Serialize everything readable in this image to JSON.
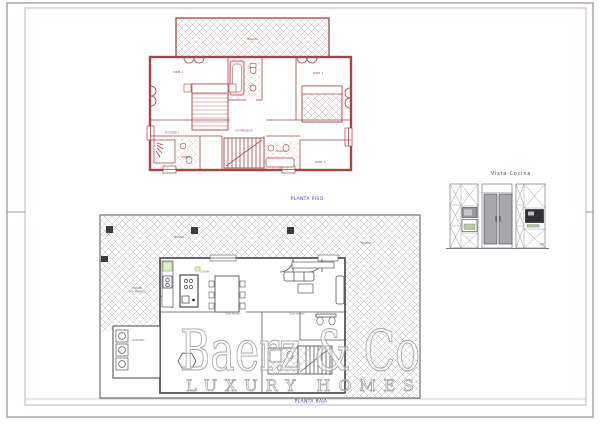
{
  "sheet": {
    "colors": {
      "upper_plan_red": "#a84444",
      "lower_plan_gray": "#56565c",
      "caption_blue": "#3a3ac8",
      "kitchen_title_green": "#3f5b52",
      "accent_green": "#86ac56",
      "frame_outer_gray": "#8f8f8f",
      "frame_inner_pink": "#dcc3dc",
      "watermark_gray": "#a9a9a9"
    }
  },
  "upper_plan": {
    "caption": "PLANTA PISO",
    "labels": {
      "terraza": "TERRAZA",
      "dorm1": "DORM. 1",
      "dorm2": "DORM. 2",
      "dorm3": "DORM. 3",
      "bano1": "BAÑO 1",
      "bano2": "BAÑO 2",
      "distribuidor": "DISTRIBUIDOR",
      "vestidor": "VESTIDOR 1"
    }
  },
  "lower_plan": {
    "caption": "PLANTA BAJA",
    "labels": {
      "terraza_top": "TERRAZA",
      "terraza_right": "TERRAZA",
      "porche1": "PORCHE",
      "porche2": "SUP. TERRAZA",
      "cocina": "COCINA",
      "lavadero": "LAVADERO",
      "cota1": "Cota de piso",
      "cota2": "Cota de piso"
    }
  },
  "kitchen_view": {
    "title": "Vista Cocina"
  },
  "watermark": {
    "brand": "Baerz & Co",
    "tagline": "LUXURY HOMES"
  }
}
